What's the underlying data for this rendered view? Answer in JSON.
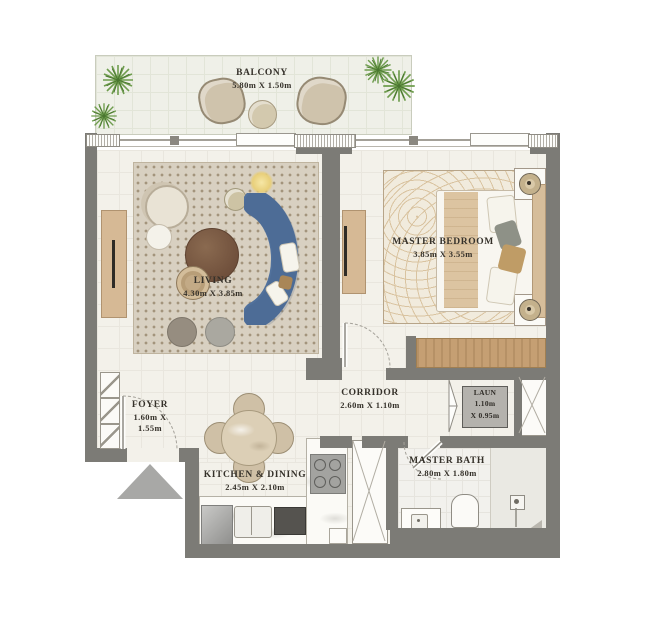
{
  "plan": {
    "rooms": {
      "balcony": {
        "name": "BALCONY",
        "dims": "5.80m X 1.50m"
      },
      "living": {
        "name": "LIVING",
        "dims": "4.30m X 3.85m"
      },
      "master_bedroom": {
        "name": "MASTER BEDROOM",
        "dims": "3.85m X 3.55m"
      },
      "corridor": {
        "name": "CORRIDOR",
        "dims": "2.60m X 1.10m"
      },
      "laundry": {
        "name": "LAUN",
        "dims_line1": "1.10m",
        "dims_line2": "X 0.95m"
      },
      "foyer": {
        "name": "FOYER",
        "dims_line1": "1.60m X",
        "dims_line2": "1.55m"
      },
      "kitchen_dining": {
        "name": "KITCHEN & DINING",
        "dims": "2.45m X 2.10m"
      },
      "master_bath": {
        "name": "MASTER BATH",
        "dims": "2.80m X 1.80m"
      }
    },
    "colors": {
      "wall": "#7c7b76",
      "floor": "#f3f1ea",
      "balcony_floor": "#eff0e8",
      "living_rug": "#d8d0c1",
      "bedroom_rug": "#f1ebdd",
      "sofa_blue": "#51719c",
      "wood": "#c59f73",
      "entry_marker": "#a8a8a6",
      "label_text": "#35312a",
      "laundry_box": "#b4b2ad",
      "plant_green": "#6f9d4e"
    }
  }
}
